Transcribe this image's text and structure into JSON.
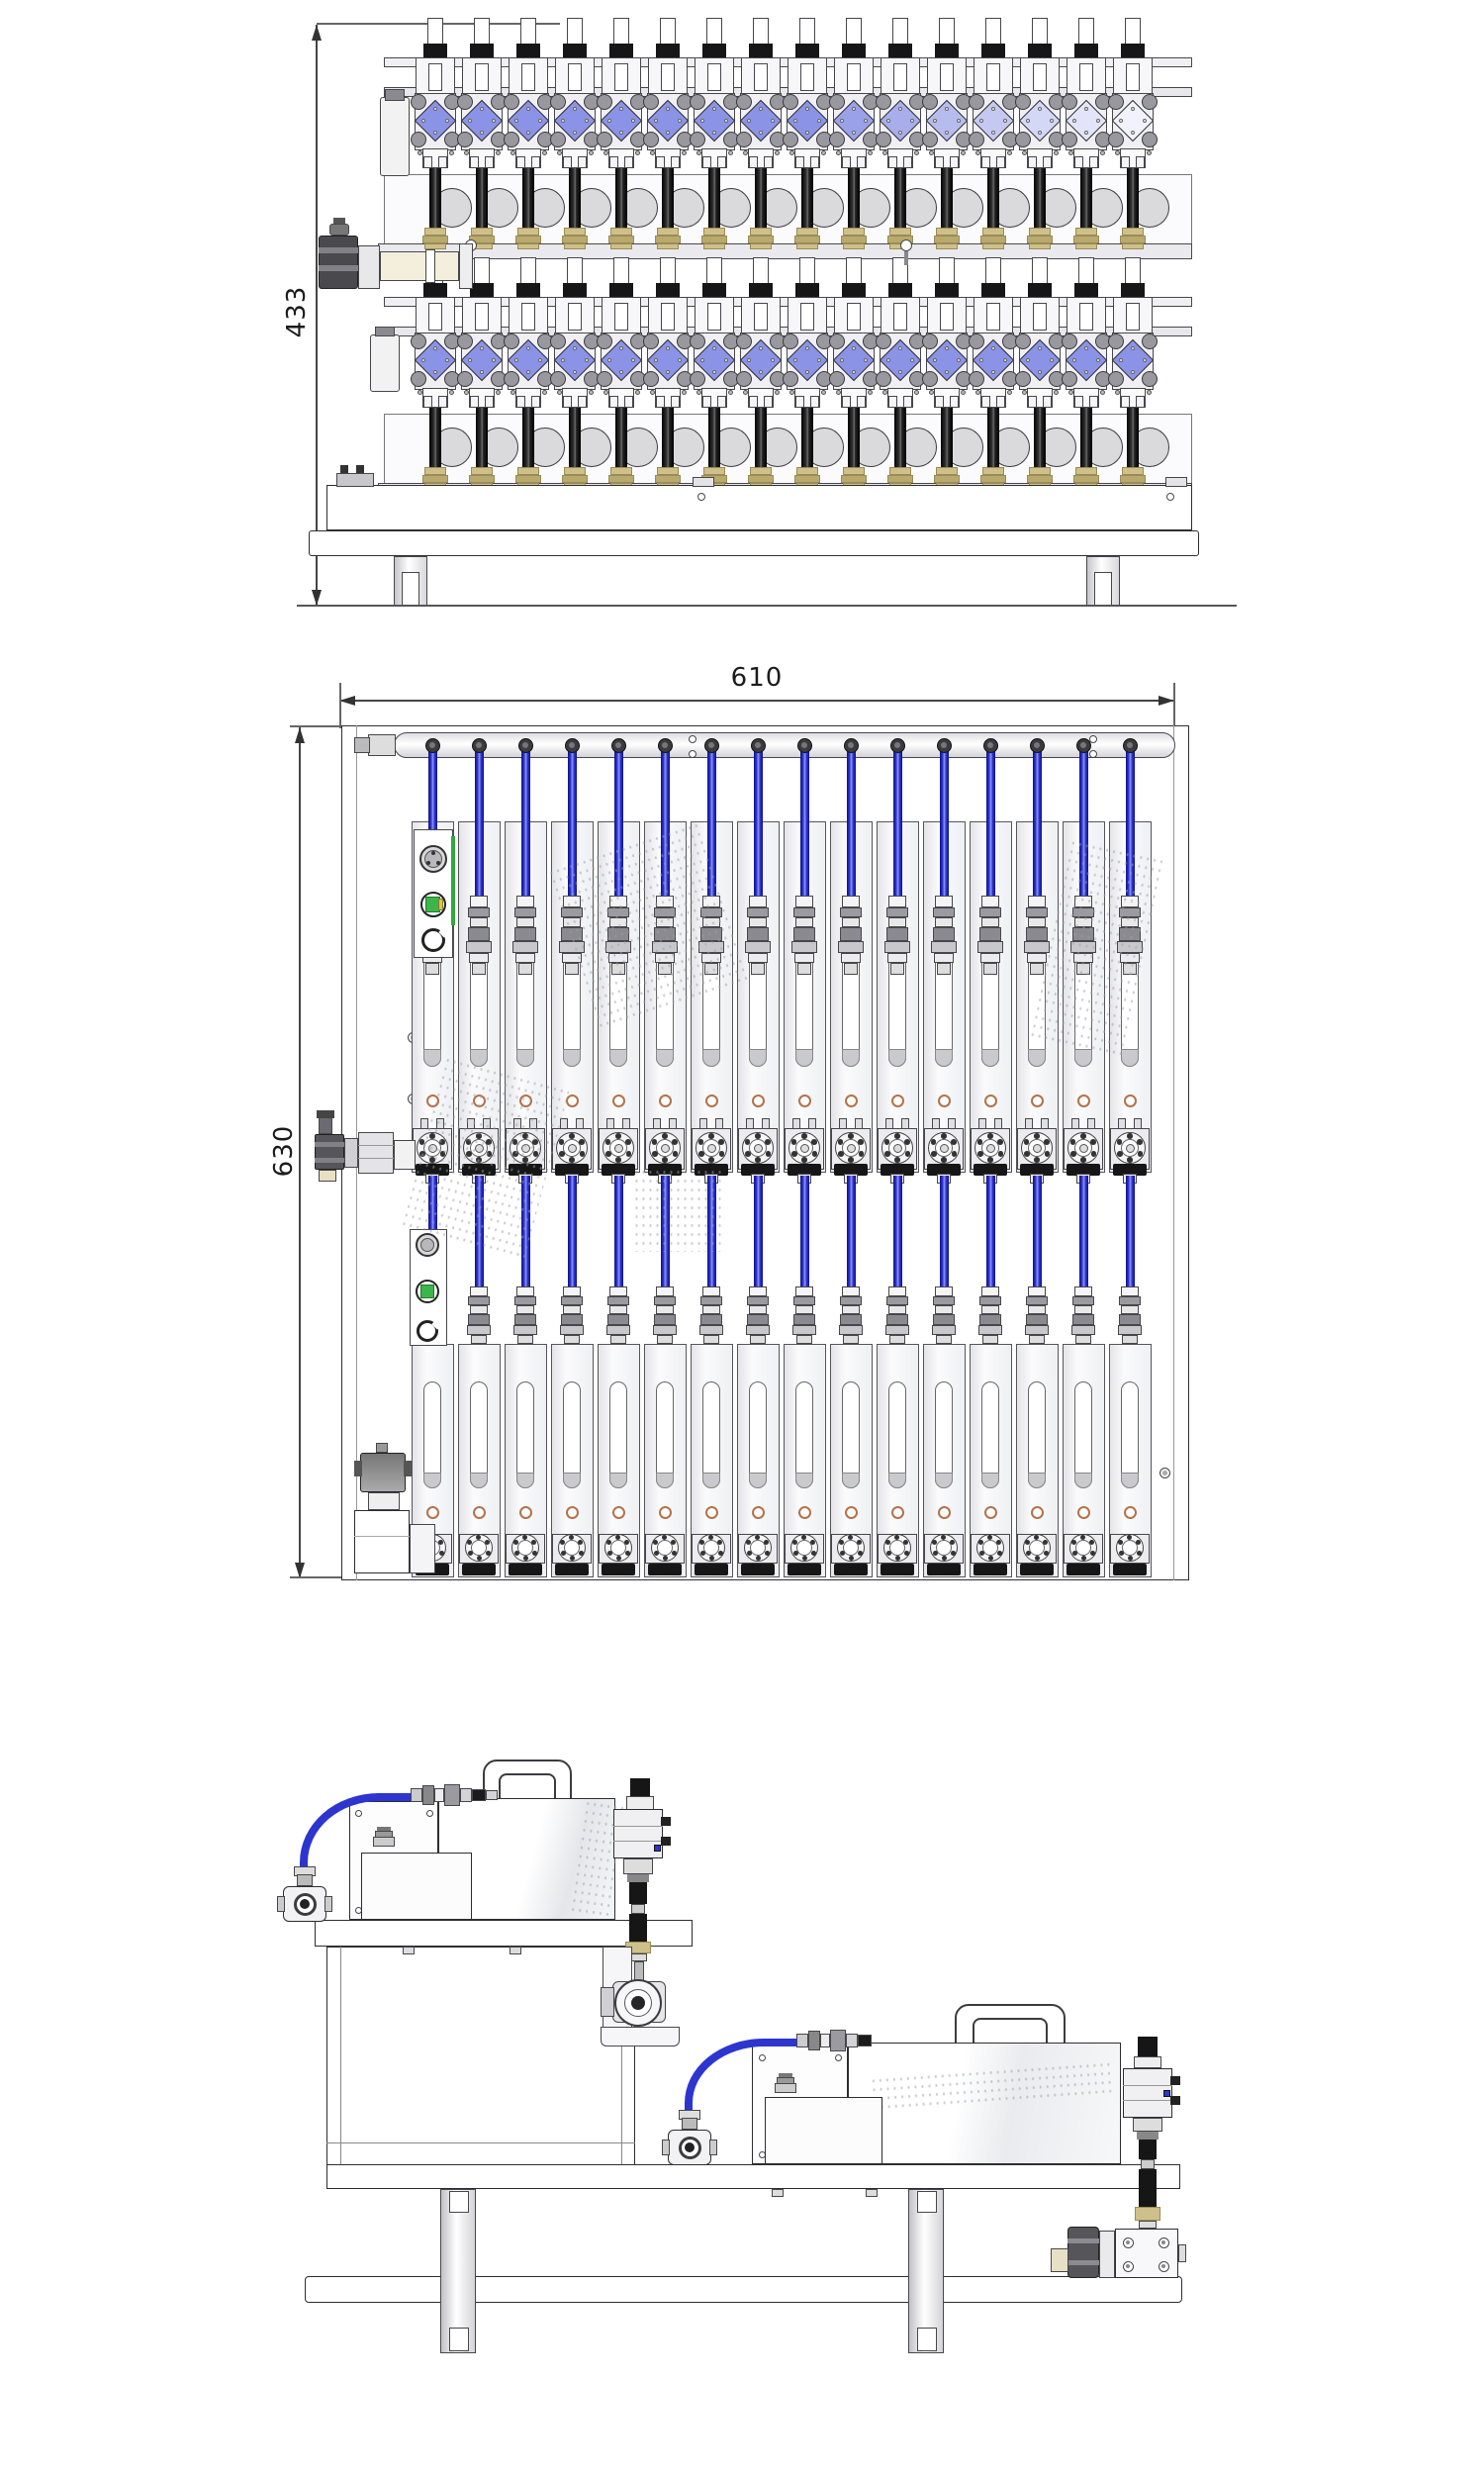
{
  "drawing_title": "valve-manifold-system-three-view-technical-drawing",
  "views": {
    "front": {
      "dimension_height_label": "433",
      "valve_columns": 16,
      "valve_rows": 2,
      "components": [
        "solenoid-dispense-valve",
        "pump-head",
        "compression-fitting",
        "inlet-ball-valve",
        "filter-canister",
        "mounting-base",
        "support-leg"
      ]
    },
    "plan": {
      "dimension_width_label": "610",
      "dimension_height_label": "630",
      "module_columns": 16,
      "banks": 2,
      "components": [
        "distribution-manifold",
        "fluid-tube",
        "quick-connector",
        "flow-module",
        "sight-window",
        "module-flange",
        "power-connector",
        "level-indicator",
        "clamp-ring",
        "agitator-motor"
      ]
    },
    "side": {
      "pump_count": 2,
      "components": [
        "melter-unit",
        "carry-handle",
        "melter-tank",
        "control-box",
        "fluid-tube",
        "ball-valve",
        "outlet-valve-block",
        "pipe-clamp",
        "mounting-shelf",
        "base-rail",
        "support-leg"
      ]
    }
  },
  "colors": {
    "line": "#47474c",
    "line_dark": "#2e2e32",
    "valve_blue": "#8b93e6",
    "valve_blue_pale": "#f3f4fc",
    "tube_blue": "#2d35cf",
    "tube_blue_dark": "#10127e",
    "tube_blue_light": "#8d96ff",
    "brass": "#cfc08a",
    "brass_dark": "#9a8c55",
    "gray_fill": "#ececf0",
    "gray_mid": "#98989e",
    "copper_ring": "#b4724a",
    "indicator_green": "#3cb54a",
    "indicator_yellow": "#d6c84a",
    "black_part": "#161616"
  }
}
